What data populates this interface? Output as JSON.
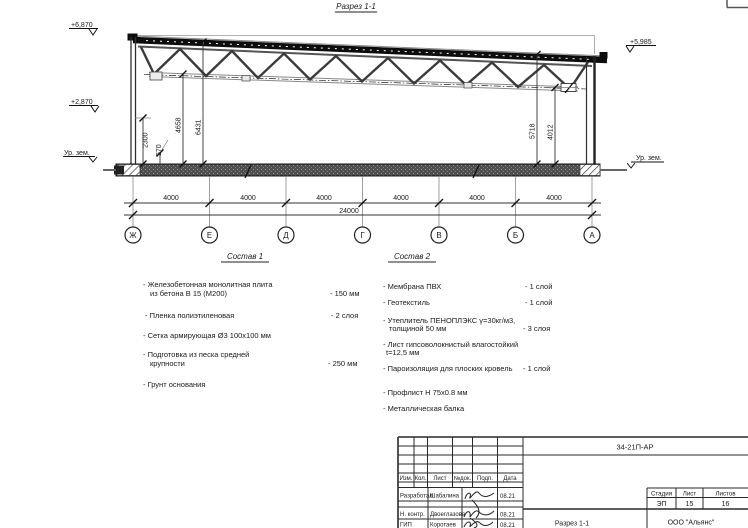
{
  "section": {
    "title": "Разрез 1-1",
    "elev_top_left": "+6,870",
    "elev_mid_left": "+2,870",
    "elev_top_right": "+5,985",
    "ground_left": "Ур. зем.",
    "ground_right": "Ур. зем.",
    "dim_2300": "2300",
    "dim_570": "570",
    "dim_4658": "4658",
    "dim_6431": "6431",
    "dim_5718": "5718",
    "dim_4012": "4012",
    "axes": [
      "Ж",
      "Е",
      "Д",
      "Г",
      "В",
      "Б",
      "А"
    ],
    "bay_dims": [
      "4000",
      "4000",
      "4000",
      "4000",
      "4000",
      "4000"
    ],
    "total_dim": "24000"
  },
  "sostav1": {
    "heading": "Состав 1",
    "items": [
      {
        "line1": "- Железобетонная  монолитная плита",
        "line2": "из бетона В 15 (М200)",
        "value": "- 150 мм"
      },
      {
        "line1": "- Пленка полиэтиленовая",
        "value": "- 2 слоя"
      },
      {
        "line1": "- Сетка армирующая Ø3 100х100 мм",
        "value": ""
      },
      {
        "line1": "- Подготовка из песка средней",
        "line2": "крупности",
        "value": "- 250 мм"
      },
      {
        "line1": "- Грунт основания",
        "value": ""
      }
    ]
  },
  "sostav2": {
    "heading": "Состав 2",
    "items": [
      {
        "line1": "- Мембрана ПВХ",
        "value": "- 1 слой"
      },
      {
        "line1": "- Геотекстиль",
        "value": "- 1 слой"
      },
      {
        "line1": "- Утеплитель ПЕНОПЛЭКС γ=30кг/м3,",
        "line2": "толщиной 50 мм",
        "value": "- 3 слоя"
      },
      {
        "line1": "- Лист гипсоволокнистый влагостойкий",
        "line2": "t=12,5 мм",
        "value": ""
      },
      {
        "line1": "- Пароизоляция для плоских кровель",
        "value": "- 1 слой"
      },
      {
        "line1": "- Профлист Н 75х0.8 мм",
        "value": ""
      },
      {
        "line1": "- Металлическая балка",
        "value": ""
      }
    ]
  },
  "stamp": {
    "doc_number": "34-21П-АР",
    "change_header": [
      "Изм.",
      "Кол.",
      "Лист",
      "№док.",
      "Подп.",
      "Дата"
    ],
    "staff": [
      {
        "role": "Разработал",
        "name": "Шабалина",
        "date": "08.21"
      },
      {
        "role": "Н. контр.",
        "name": "Двоеглазова",
        "date": "08.21"
      },
      {
        "role": "ГИП",
        "name": "Коротаев",
        "date": "08.21"
      }
    ],
    "stage_label": "Стадия",
    "sheet_label": "Лист",
    "sheets_label": "Листов",
    "stage": "ЭП",
    "sheet": "15",
    "sheets": "16",
    "drawing_name": "Разрез 1-1",
    "company": "ООО \"Альянс\""
  },
  "colors": {
    "line": "#1a1a1a",
    "slab": "#4f4f4f",
    "roof": "#0d0d0d"
  }
}
